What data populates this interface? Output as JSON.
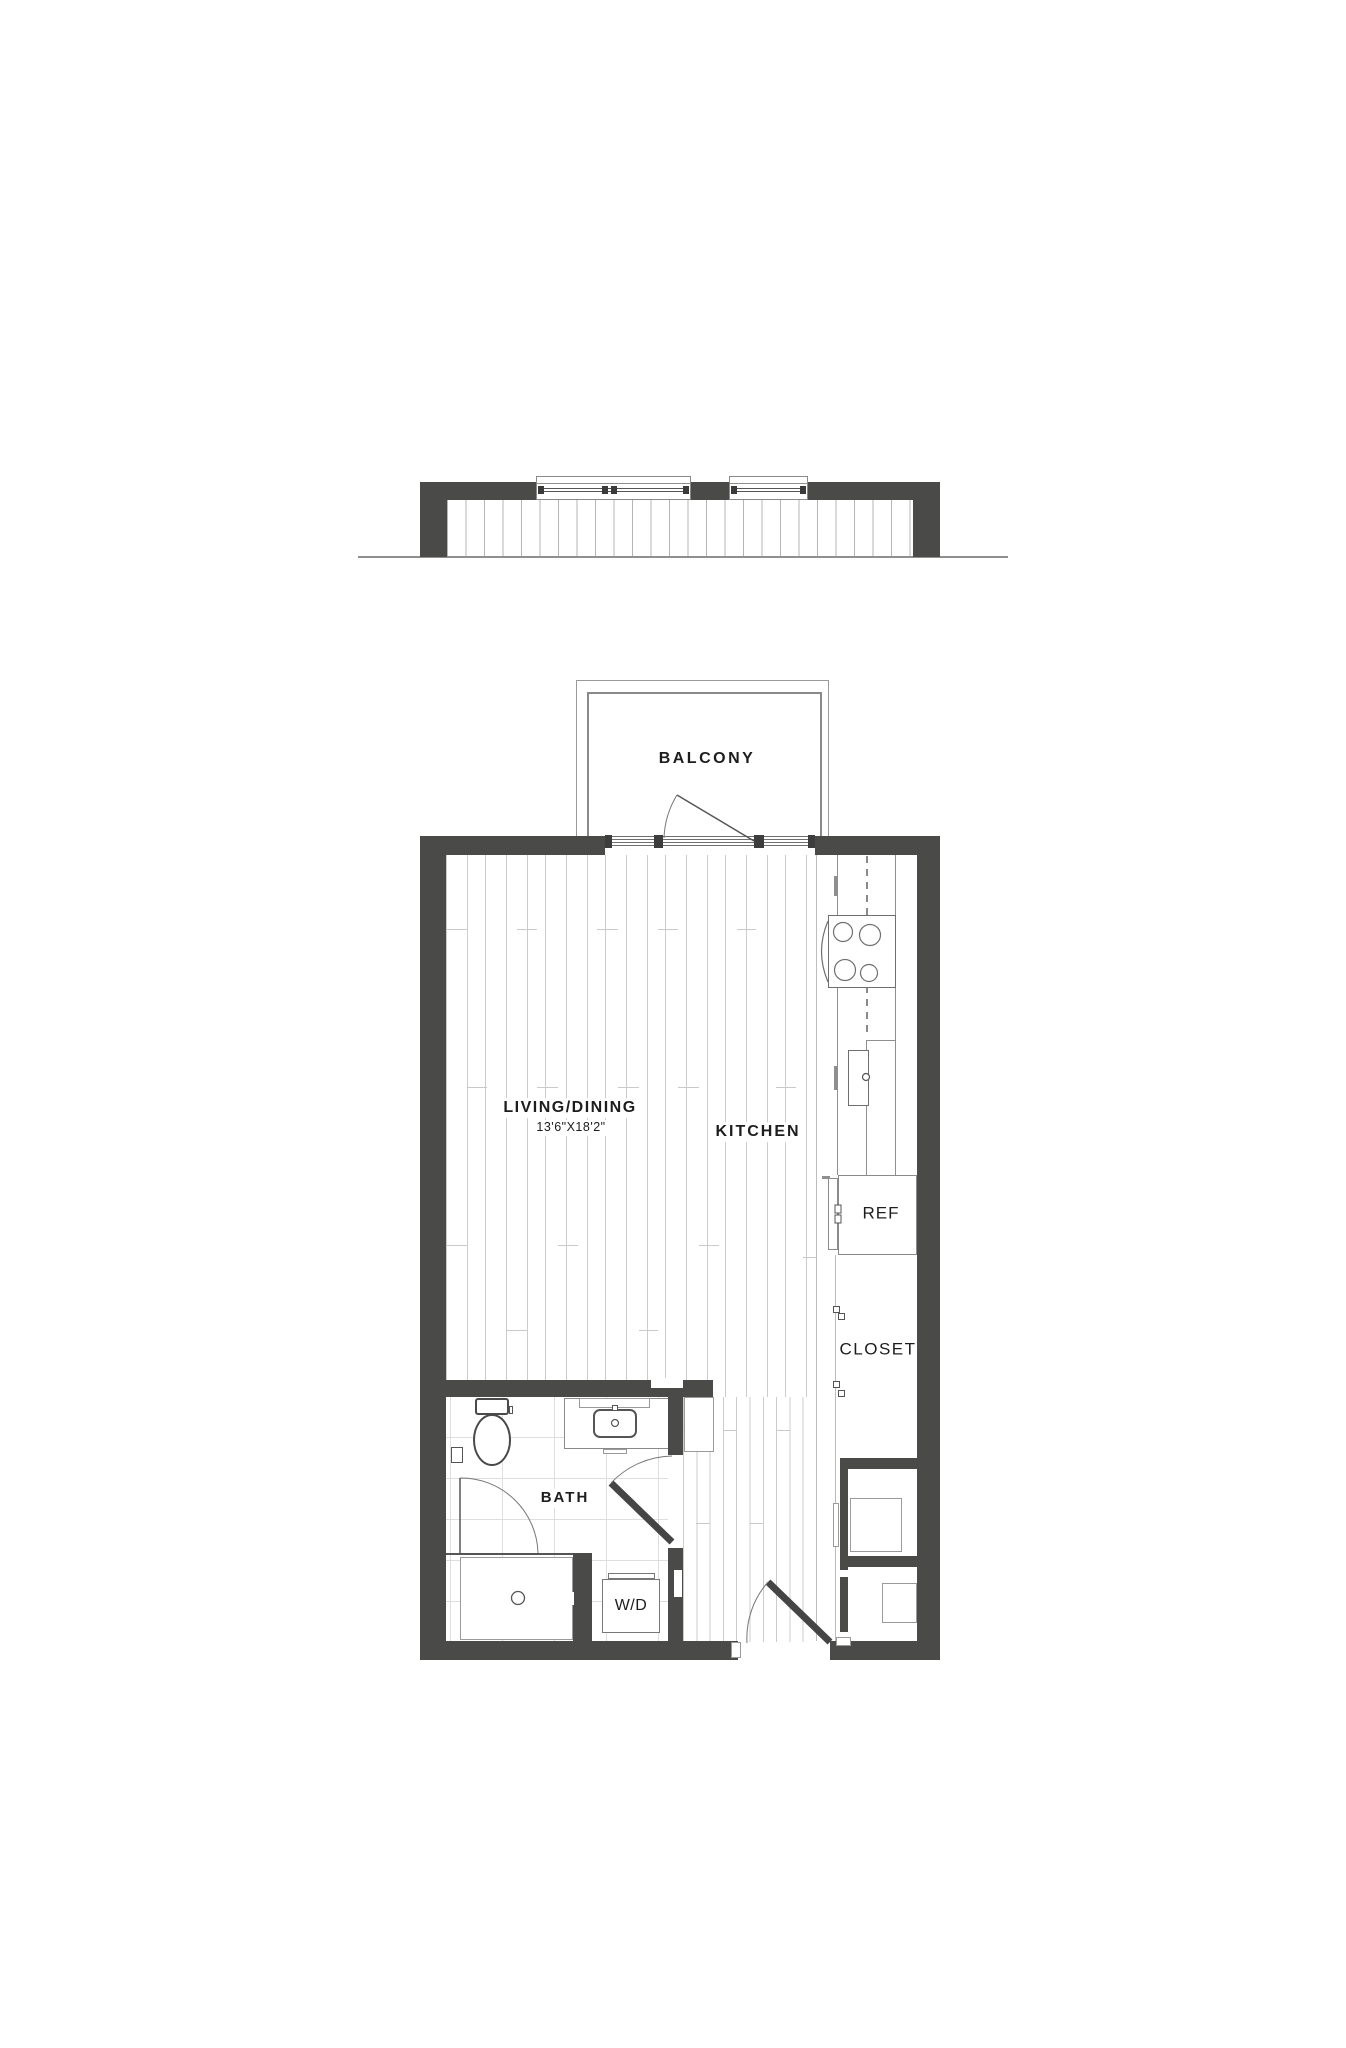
{
  "page": {
    "background": "#ffffff"
  },
  "colors": {
    "wall": "#4a4a48",
    "outline": "#8a8a8a",
    "plank_line": "#cccccc",
    "tile_line": "#dedede",
    "text": "#1d1d1d"
  },
  "floor_plan": {
    "balcony": {
      "label": "BALCONY"
    },
    "living_dining": {
      "label": "LIVING/DINING",
      "dimensions": "13'6\"X18'2\""
    },
    "kitchen": {
      "label": "KITCHEN"
    },
    "refrigerator": {
      "label": "REF"
    },
    "closet": {
      "label": "CLOSET"
    },
    "bath": {
      "label": "BATH"
    },
    "washer_dryer": {
      "label": "W/D"
    }
  }
}
